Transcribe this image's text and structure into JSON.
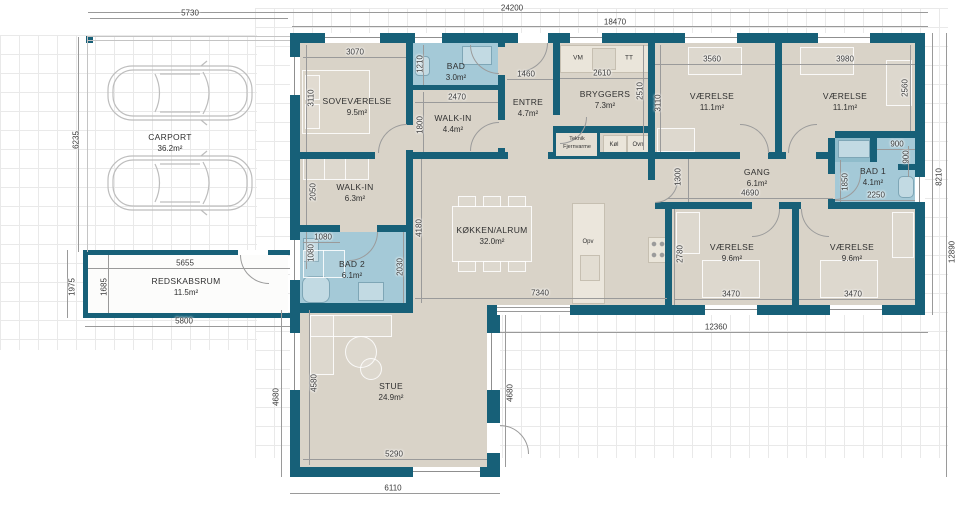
{
  "colors": {
    "wall": "#176078",
    "bath": "#a4c9d7",
    "shower_tile": "#8fbccb",
    "floor": "#d9d3c8",
    "grid_line": "#e9e9e9"
  },
  "rooms": {
    "carport": {
      "name": "CARPORT",
      "area": "36.2m²"
    },
    "redskab": {
      "name": "REDSKABSRUM",
      "area": "11.5m²"
    },
    "sove": {
      "name": "SOVEVÆRELSE",
      "area": "9.5m²"
    },
    "bad": {
      "name": "BAD",
      "area": "3.0m²"
    },
    "walkin1": {
      "name": "WALK-IN",
      "area": "4.4m²"
    },
    "entre": {
      "name": "ENTRE",
      "area": "4.7m²"
    },
    "bryggers": {
      "name": "BRYGGERS",
      "area": "7.3m²"
    },
    "v1": {
      "name": "VÆRELSE",
      "area": "11.1m²"
    },
    "v2": {
      "name": "VÆRELSE",
      "area": "11.1m²"
    },
    "walkin2": {
      "name": "WALK-IN",
      "area": "6.3m²"
    },
    "bad2": {
      "name": "BAD 2",
      "area": "6.1m²"
    },
    "koekken": {
      "name": "KØKKEN/ALRUM",
      "area": "32.0m²"
    },
    "gang": {
      "name": "GANG",
      "area": "6.1m²"
    },
    "bad1": {
      "name": "BAD 1",
      "area": "4.1m²"
    },
    "v3": {
      "name": "VÆRELSE",
      "area": "9.6m²"
    },
    "v4": {
      "name": "VÆRELSE",
      "area": "9.6m²"
    },
    "stue": {
      "name": "STUE",
      "area": "24.9m²"
    }
  },
  "appliances": {
    "vm": "VM",
    "tt": "TT",
    "teknik1": "Teknik",
    "teknik2": "Fjernvarme",
    "koel": "Køl",
    "ovn": "Ovn",
    "opv": "Opv"
  },
  "dims": {
    "overall_w": "24200",
    "house_w": "18470",
    "carport_w": "5730",
    "carport_h": "6235",
    "sove_w": "3070",
    "sove_h": "3110",
    "bad_h": "1210",
    "walkin1_w": "2470",
    "walkin1_h": "1800",
    "entre_w": "1460",
    "bryggers_w": "2610",
    "bryggers_h": "2510",
    "v1_w": "3560",
    "v1_h": "3110",
    "v2_w": "3980",
    "v2_h": "2560",
    "shower_w": "900",
    "shower_h": "900",
    "walkin2_h": "2050",
    "bad2_w": "1080",
    "bad2_h": "1080",
    "bad2_d": "2030",
    "hall_h": "4180",
    "gang_w": "4690",
    "gang_h": "1300",
    "bad1_h": "1850",
    "bad1_w": "2250",
    "right_top_h": "8210",
    "stove_h": "2780",
    "v3_w": "3470",
    "v4_w": "3470",
    "right_bottom_h": "12890",
    "kitchen_w": "7340",
    "south_w": "12360",
    "redskab_w": "5655",
    "redskab_h": "1685",
    "redskab_oh": "1975",
    "redskab_ow": "5800",
    "stue_h": "4580",
    "stue_ol": "4680",
    "stue_or": "4680",
    "stue_w": "5290",
    "stue_ow": "6110"
  }
}
